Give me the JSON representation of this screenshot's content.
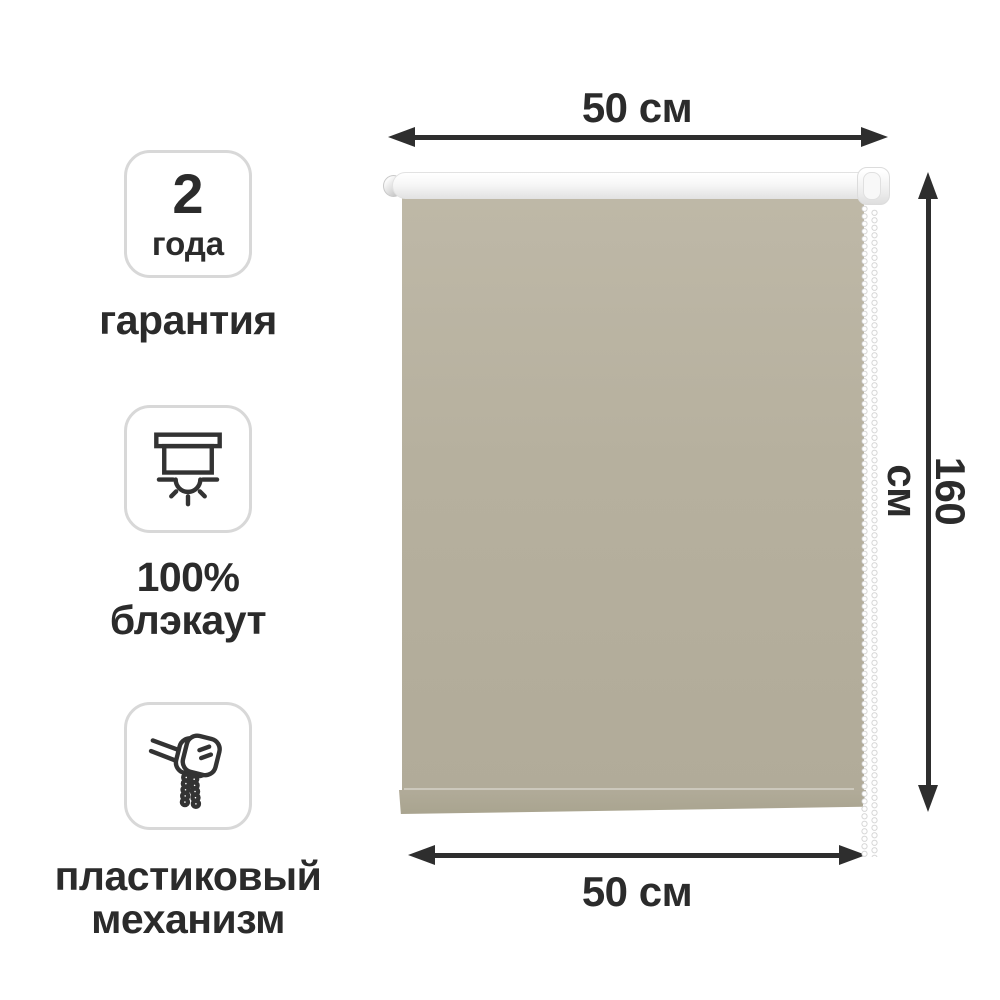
{
  "features": [
    {
      "name": "warranty",
      "badge_value": "2",
      "badge_unit": "года",
      "label_lines": [
        "гарантия"
      ]
    },
    {
      "name": "blackout",
      "icon": "blackout-blind-icon",
      "label_lines": [
        "100%",
        "блэкаут"
      ]
    },
    {
      "name": "mechanism",
      "icon": "roller-mechanism-icon",
      "label_lines": [
        "пластиковый",
        "механизм"
      ]
    }
  ],
  "dimensions": {
    "top_width": "50 см",
    "right_height": "160 см",
    "bottom_width": "50 см"
  },
  "colors": {
    "text": "#2b2b2b",
    "arrow": "#2e2e2e",
    "badge-border": "#d8d8d8",
    "icon-stroke": "#333333",
    "fabric-top": "#beb8a7",
    "fabric-mid": "#b6b09e",
    "fabric-bottom": "#b1ab99",
    "hem": "#a9a48f",
    "tube-hi": "#ffffff",
    "tube-lo": "#e3e3e3"
  }
}
